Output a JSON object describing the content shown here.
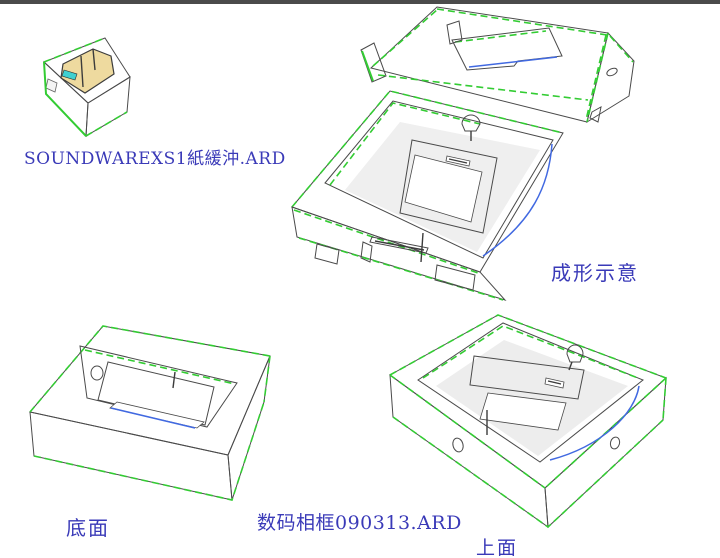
{
  "canvas": {
    "background": "#ffffff",
    "top_bar_color": "#4b4b4b"
  },
  "palette": {
    "board_face_light": "#ececec",
    "board_face_mid": "#dedede",
    "board_face_dark": "#d0d0d0",
    "recess_wall_gray": "#d5d5d5",
    "manila_insert_tan": "#eeda9f",
    "fold_line_green": "#33cc33",
    "cut_line_blue": "#4169e1",
    "edge_outline": "#4a4a4a",
    "accent_cyan": "#3fd0d0",
    "label_text_blue": "#3a3ab8"
  },
  "labels": {
    "buffer_file_name": "SOUNDWAREXS1紙緩沖.ARD",
    "forming_caption": "成形示意",
    "bottom_view_caption": "底面",
    "design_file_name": "数码相框090313.ARD",
    "top_view_caption": "上面"
  }
}
